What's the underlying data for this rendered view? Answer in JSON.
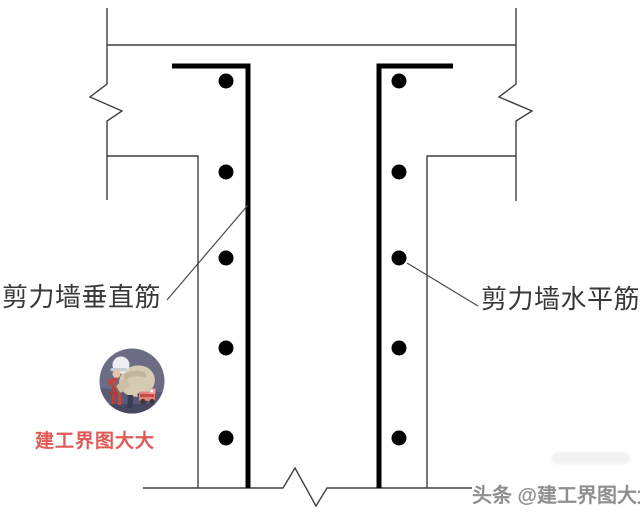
{
  "colors": {
    "background": "#ffffff",
    "outline": "#3f3f3f",
    "rebar": "#000000",
    "dot": "#000000",
    "leader": "#4a4a4a",
    "label_text": "#383838",
    "watermark_red": "#e05a55",
    "credit_gray": "#8f8f8f"
  },
  "labels": {
    "left": "剪力墙垂直筋",
    "right": "剪力墙水平筋"
  },
  "watermark": {
    "name": "建工界图大大"
  },
  "credit": {
    "text": "头条 @建工界图大大"
  },
  "diagram": {
    "canvas": {
      "width": 640,
      "height": 514
    },
    "outline_stroke_width": 1.4,
    "rebar_stroke_width": 5,
    "leader_stroke_width": 1.2,
    "dot_radius": 7.5,
    "outline_segments": [
      {
        "name": "top-wall-edge",
        "points": [
          [
            107,
            45
          ],
          [
            516,
            45
          ]
        ]
      },
      {
        "name": "left-break-line",
        "points": [
          [
            107,
            8
          ],
          [
            107,
            84
          ],
          [
            90,
            97
          ],
          [
            122,
            111
          ],
          [
            107,
            121
          ],
          [
            107,
            200
          ]
        ]
      },
      {
        "name": "right-break-line",
        "points": [
          [
            516,
            8
          ],
          [
            516,
            84
          ],
          [
            499,
            97
          ],
          [
            532,
            111
          ],
          [
            516,
            121
          ],
          [
            516,
            201
          ]
        ]
      },
      {
        "name": "left-wall-face",
        "points": [
          [
            107,
            156
          ],
          [
            198,
            156
          ],
          [
            198,
            488
          ]
        ]
      },
      {
        "name": "right-wall-face",
        "points": [
          [
            516,
            156
          ],
          [
            427,
            156
          ],
          [
            427,
            488
          ]
        ]
      },
      {
        "name": "bottom-break-line",
        "points": [
          [
            143,
            488
          ],
          [
            283,
            488
          ],
          [
            295,
            468
          ],
          [
            316,
            506
          ],
          [
            327,
            488
          ],
          [
            472,
            488
          ]
        ]
      }
    ],
    "rebar_lines": [
      {
        "name": "left-vertical-rebar-bar",
        "points": [
          [
            172,
            66
          ],
          [
            248,
            66
          ],
          [
            248,
            488
          ]
        ]
      },
      {
        "name": "right-vertical-rebar-bar",
        "points": [
          [
            453,
            66
          ],
          [
            379,
            66
          ],
          [
            379,
            488
          ]
        ]
      }
    ],
    "leader_lines": [
      {
        "name": "vertical-rebar-leader",
        "points": [
          [
            167,
            300
          ],
          [
            248,
            205
          ]
        ]
      },
      {
        "name": "horizontal-rebar-leader",
        "points": [
          [
            407,
            263
          ],
          [
            478,
            306
          ]
        ]
      }
    ],
    "dots": {
      "columns_x": [
        226,
        399
      ],
      "rows_y": [
        81,
        172,
        258,
        348,
        438
      ]
    }
  }
}
